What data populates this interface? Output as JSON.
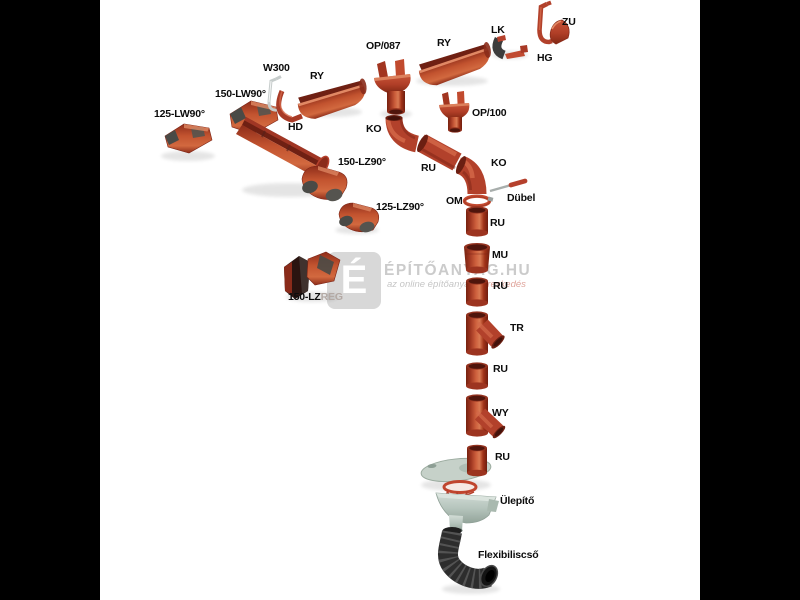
{
  "window": {
    "background": "#000000",
    "content_background": "#ffffff"
  },
  "watermark": {
    "logo_letter": "É",
    "title": "ÉPÍTŐANYAG.HU",
    "subtitle_prefix": "az online építőanyag ",
    "subtitle_highlight": "kereskedés"
  },
  "palette": {
    "part_red": "#b2412b",
    "part_red_dark": "#7c2315",
    "part_red_light": "#d4694a",
    "metal_gray": "#4a4a46",
    "trap_gray": "#b6c5bd",
    "hose_black": "#2d2d2d",
    "label_color": "#0c0c0c",
    "watermark_gray": "#cbcbcb"
  },
  "labels": [
    {
      "id": "125-lw90",
      "text": "125-LW90°"
    },
    {
      "id": "150-lw90",
      "text": "150-LW90°"
    },
    {
      "id": "w300",
      "text": "W300"
    },
    {
      "id": "ry-left",
      "text": "RY"
    },
    {
      "id": "hd",
      "text": "HD"
    },
    {
      "id": "150-lz90",
      "text": "150-LZ90°"
    },
    {
      "id": "125-lz90",
      "text": "125-LZ90°"
    },
    {
      "id": "150-lzreg-main",
      "text": "150-LZ"
    },
    {
      "id": "150-lzreg-suffix",
      "text": "REG"
    },
    {
      "id": "op087",
      "text": "OP/087"
    },
    {
      "id": "ry-right",
      "text": "RY"
    },
    {
      "id": "lk",
      "text": "LK"
    },
    {
      "id": "zu",
      "text": "ZU"
    },
    {
      "id": "hg",
      "text": "HG"
    },
    {
      "id": "op100",
      "text": "OP/100"
    },
    {
      "id": "ko-upper",
      "text": "KO"
    },
    {
      "id": "ru-diagonal",
      "text": "RU"
    },
    {
      "id": "ko-lower",
      "text": "KO"
    },
    {
      "id": "om",
      "text": "OM"
    },
    {
      "id": "dubel",
      "text": "Dübel"
    },
    {
      "id": "ru-1",
      "text": "RU"
    },
    {
      "id": "mu",
      "text": "MU"
    },
    {
      "id": "ru-2",
      "text": "RU"
    },
    {
      "id": "tr",
      "text": "TR"
    },
    {
      "id": "ru-3",
      "text": "RU"
    },
    {
      "id": "wy",
      "text": "WY"
    },
    {
      "id": "ru-4",
      "text": "RU"
    },
    {
      "id": "ulepito",
      "text": "Ülepítő"
    },
    {
      "id": "flexibiliscso",
      "text": "Flexibiliscső"
    }
  ]
}
